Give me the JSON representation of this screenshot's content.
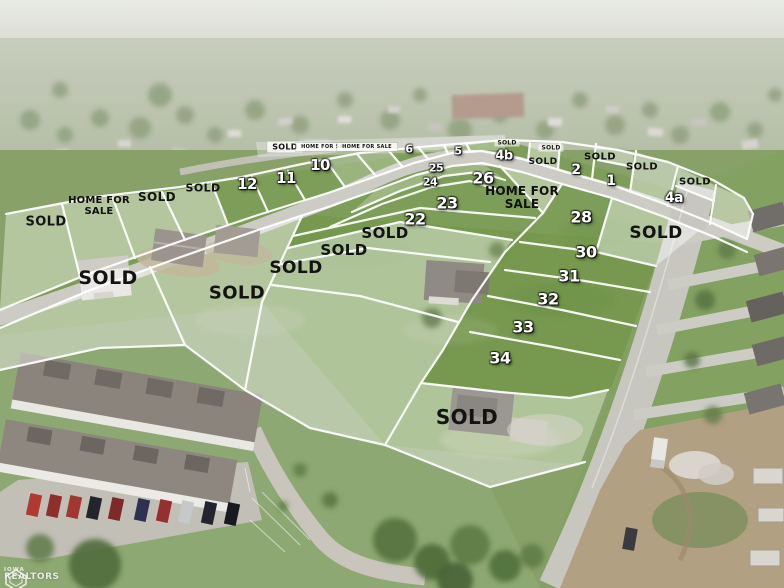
{
  "watermark": {
    "org_line1": "IOWA",
    "org_line2": "REALTORS"
  },
  "label_text": {
    "sold": "SOLD",
    "home_for_sale": "HOME FOR SALE"
  },
  "colors": {
    "lot_line": "#ffffff",
    "sold_text": "#131313",
    "number_text": "#ffffff",
    "sold_overlay": "rgba(255,255,255,0.42)",
    "grass_green": "#7b9c55",
    "road_gray": "#c9c8c1"
  },
  "lots": [
    {
      "t": "SOLD",
      "x": 285,
      "y": 147,
      "k": "chip",
      "fs": 8
    },
    {
      "t": "HOME FOR SALE",
      "x": 326,
      "y": 147,
      "k": "chip",
      "fs": 5
    },
    {
      "t": "HOME FOR SALE",
      "x": 367,
      "y": 147,
      "k": "chip",
      "fs": 5
    },
    {
      "t": "6",
      "x": 409,
      "y": 149,
      "k": "num",
      "fs": 11
    },
    {
      "t": "5",
      "x": 458,
      "y": 151,
      "k": "num",
      "fs": 11
    },
    {
      "t": "SOLD",
      "x": 507,
      "y": 143,
      "k": "chipsm",
      "fs": 6
    },
    {
      "t": "4b",
      "x": 504,
      "y": 156,
      "k": "num",
      "fs": 13
    },
    {
      "t": "SOLD",
      "x": 551,
      "y": 148,
      "k": "chipsm",
      "fs": 6
    },
    {
      "t": "SOLD",
      "x": 543,
      "y": 162,
      "k": "sold",
      "fs": 9
    },
    {
      "t": "2",
      "x": 576,
      "y": 170,
      "k": "num",
      "fs": 14
    },
    {
      "t": "SOLD",
      "x": 600,
      "y": 157,
      "k": "sold",
      "fs": 10
    },
    {
      "t": "1",
      "x": 611,
      "y": 181,
      "k": "num",
      "fs": 14
    },
    {
      "t": "SOLD",
      "x": 642,
      "y": 167,
      "k": "sold",
      "fs": 10
    },
    {
      "t": "4a",
      "x": 674,
      "y": 198,
      "k": "num",
      "fs": 14
    },
    {
      "t": "SOLD",
      "x": 695,
      "y": 182,
      "k": "sold",
      "fs": 10
    },
    {
      "t": "10",
      "x": 320,
      "y": 165,
      "k": "num",
      "fs": 15
    },
    {
      "t": "11",
      "x": 286,
      "y": 178,
      "k": "num",
      "fs": 15
    },
    {
      "t": "12",
      "x": 247,
      "y": 184,
      "k": "num",
      "fs": 15
    },
    {
      "t": "SOLD",
      "x": 203,
      "y": 188,
      "k": "sold",
      "fs": 11
    },
    {
      "t": "SOLD",
      "x": 157,
      "y": 197,
      "k": "sold",
      "fs": 12
    },
    {
      "t": "HOME FOR|SALE",
      "x": 99,
      "y": 207,
      "k": "hfs",
      "fs": 10
    },
    {
      "t": "SOLD",
      "x": 46,
      "y": 222,
      "k": "sold",
      "fs": 13
    },
    {
      "t": "25",
      "x": 436,
      "y": 168,
      "k": "num",
      "fs": 11
    },
    {
      "t": "24",
      "x": 430,
      "y": 182,
      "k": "num",
      "fs": 11
    },
    {
      "t": "26",
      "x": 483,
      "y": 178,
      "k": "num",
      "fs": 16
    },
    {
      "t": "HOME FOR|SALE",
      "x": 522,
      "y": 198,
      "k": "hfs",
      "fs": 12
    },
    {
      "t": "23",
      "x": 447,
      "y": 203,
      "k": "num",
      "fs": 16
    },
    {
      "t": "22",
      "x": 415,
      "y": 219,
      "k": "num",
      "fs": 16
    },
    {
      "t": "SOLD",
      "x": 385,
      "y": 233,
      "k": "sold",
      "fs": 15
    },
    {
      "t": "SOLD",
      "x": 344,
      "y": 250,
      "k": "sold",
      "fs": 15
    },
    {
      "t": "SOLD",
      "x": 296,
      "y": 268,
      "k": "sold",
      "fs": 17
    },
    {
      "t": "SOLD",
      "x": 237,
      "y": 293,
      "k": "sold",
      "fs": 18
    },
    {
      "t": "SOLD",
      "x": 108,
      "y": 278,
      "k": "sold",
      "fs": 19
    },
    {
      "t": "28",
      "x": 581,
      "y": 217,
      "k": "num",
      "fs": 16
    },
    {
      "t": "SOLD",
      "x": 656,
      "y": 233,
      "k": "sold",
      "fs": 17
    },
    {
      "t": "30",
      "x": 586,
      "y": 252,
      "k": "num",
      "fs": 16
    },
    {
      "t": "31",
      "x": 569,
      "y": 276,
      "k": "num",
      "fs": 16
    },
    {
      "t": "32",
      "x": 548,
      "y": 299,
      "k": "num",
      "fs": 16
    },
    {
      "t": "33",
      "x": 523,
      "y": 327,
      "k": "num",
      "fs": 16
    },
    {
      "t": "34",
      "x": 500,
      "y": 358,
      "k": "num",
      "fs": 16
    },
    {
      "t": "SOLD",
      "x": 467,
      "y": 417,
      "k": "sold",
      "fs": 20
    }
  ]
}
